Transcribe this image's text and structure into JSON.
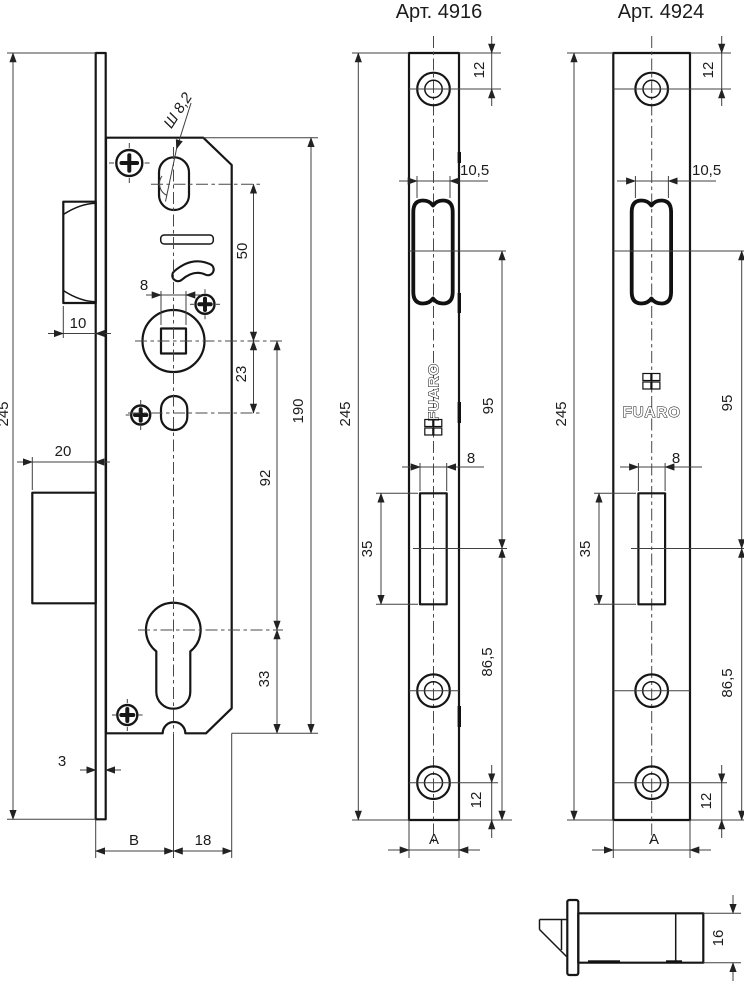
{
  "titles": {
    "left": "Арт. 4916",
    "right": "Арт. 4924"
  },
  "brand": {
    "name": "FUARO"
  },
  "colors": {
    "line": "#161616",
    "dim": "#404040",
    "background": "#ffffff"
  },
  "body": {
    "overall_height": "245",
    "latch_hole": "Ш 8,2",
    "hole_to_spindle": "50",
    "spindle_square": "8",
    "latch_width": "10",
    "spindle_to_oval": "23",
    "bolt_throw": "20",
    "spindle_to_cylinder": "92",
    "case_height": "190",
    "cylinder_to_bottom": "33",
    "faceplate_thickness": "3",
    "backset": "B",
    "center_to_edge": "18"
  },
  "plate1": {
    "top_hole": "12",
    "latch_slot_width": "10,5",
    "height": "245",
    "latch_to_bolt": "95",
    "bolt_slot_width": "8",
    "bolt_slot_height": "35",
    "bolt_to_bottom": "86,5",
    "bottom_hole": "12",
    "width": "A"
  },
  "plate2": {
    "top_hole": "12",
    "latch_slot_width": "10,5",
    "height": "245",
    "latch_to_bolt": "95",
    "bolt_slot_width": "8",
    "bolt_slot_height": "35",
    "bolt_to_bottom": "86,5",
    "bottom_hole": "12",
    "width": "A"
  },
  "side": {
    "thickness": "16"
  }
}
